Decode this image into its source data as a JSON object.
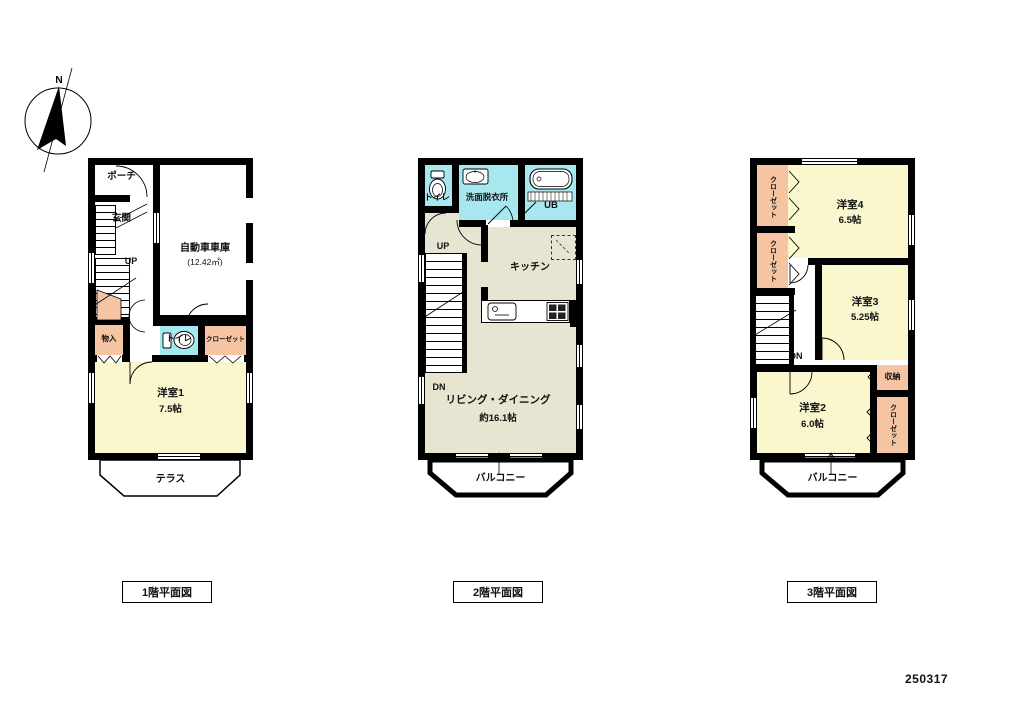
{
  "page": {
    "number": "250317"
  },
  "compass": {
    "north": "N"
  },
  "palette": {
    "wall": "#000000",
    "room_yellow": "#FAF7CF",
    "ldk_beige": "#E7E5D2",
    "water_cyan": "#A6E7F0",
    "closet_salmon": "#F5C5A3"
  },
  "floor1": {
    "caption": "1階平面図",
    "porch": "ポーチ",
    "entrance": "玄関",
    "garage_name": "自動車車庫",
    "garage_area": "(12.42㎡)",
    "up": "UP",
    "storage": "物入",
    "toilet": "トイレ",
    "closet": "クローゼット",
    "room1_name": "洋室1",
    "room1_size": "7.5帖",
    "terrace": "テラス"
  },
  "floor2": {
    "caption": "2階平面図",
    "toilet": "トイレ",
    "washroom": "洗面脱衣所",
    "bath": "UB",
    "kitchen": "キッチン",
    "up": "UP",
    "down": "DN",
    "living_name": "リビング・ダイニング",
    "living_size": "約16.1帖",
    "balcony": "バルコニー"
  },
  "floor3": {
    "caption": "3階平面図",
    "closet1": "クローゼット",
    "closet2": "クローゼット",
    "room4_name": "洋室4",
    "room4_size": "6.5帖",
    "room3_name": "洋室3",
    "room3_size": "5.25帖",
    "down": "DN",
    "room2_name": "洋室2",
    "room2_size": "6.0帖",
    "storage": "収納",
    "closet3": "クローゼット",
    "balcony": "バルコニー"
  }
}
